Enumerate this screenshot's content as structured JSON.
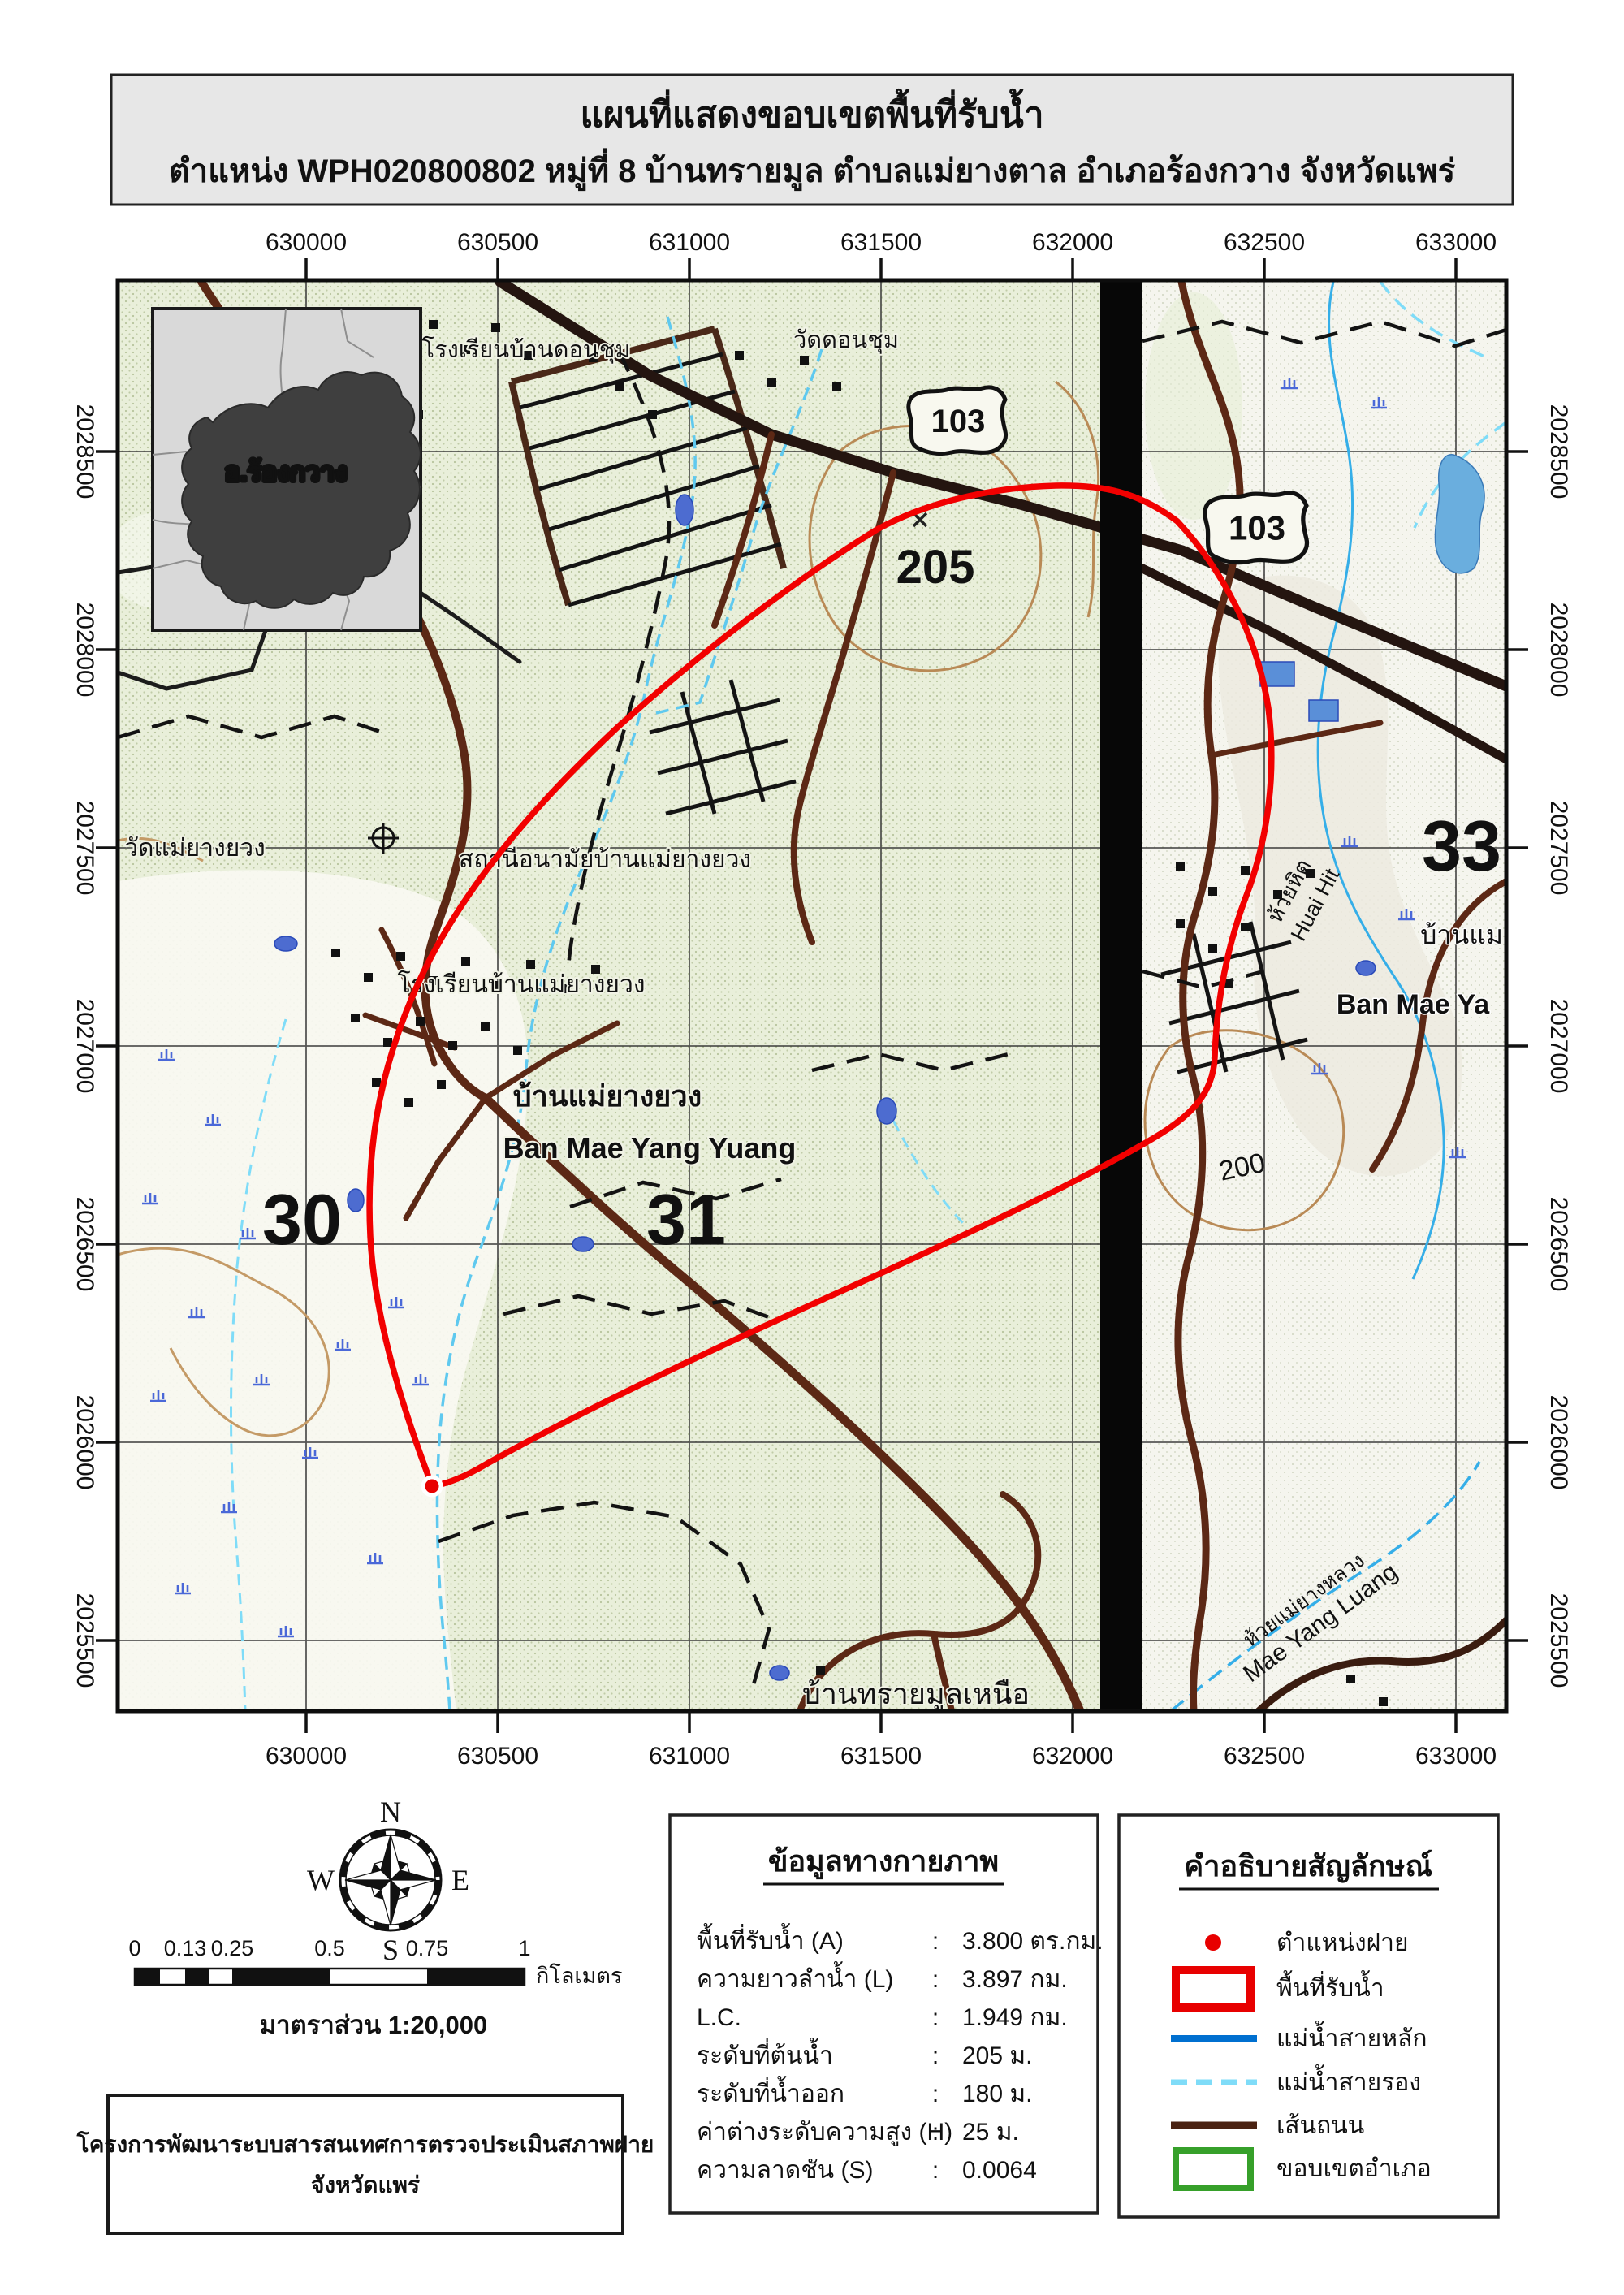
{
  "title": {
    "line1": "แผนที่แสดงขอบเขตพื้นที่รับน้ำ",
    "line2": "ตำแหน่ง WPH020800802 หมู่ที่ 8 บ้านทรายมูล ตำบลแม่ยางตาล อำเภอร้องกวาง จังหวัดแพร่"
  },
  "map": {
    "inset_label": "อ.ร้องกวาง",
    "route_number": "103",
    "axis": {
      "easting": [
        "630000",
        "630500",
        "631000",
        "631500",
        "632000",
        "632500",
        "633000"
      ],
      "northing": [
        "2028500",
        "2028000",
        "2027500",
        "2027000",
        "2026500",
        "2026000",
        "2025500"
      ]
    },
    "labels": {
      "school_don_chum": "โรงเรียนบ้านดอนชุม",
      "wat_don_chum": "วัดดอนชุม",
      "spot_height": "205",
      "contour_200": "200",
      "grid_30": "30",
      "grid_31": "31",
      "grid_33": "33",
      "wat_mae_yang_yuang": "วัดแม่ยางยวง",
      "health_station": "สถานีอนามัยบ้านแม่ยางยวง",
      "school_mae_yang_yuang": "โรงเรียนบ้านแม่ยางยวง",
      "village_thai": "บ้านแม่ยางยวง",
      "village_eng": "Ban Mae Yang Yuang",
      "ban_mae_thai_partial": "บ้านแม",
      "ban_mae_eng_partial": "Ban Mae Ya",
      "huai_hit_thai": "ห้วยหิต",
      "huai_hit_eng": "Huai Hit",
      "mae_yang_luang_thai": "ห้วยแม่ยางหลวง",
      "mae_yang_luang_eng": "Mae Yang Luang",
      "ban_sai_mun_nuea": "บ้านทรายมูลเหนือ"
    }
  },
  "compass": {
    "n": "N",
    "e": "E",
    "s": "S",
    "w": "W"
  },
  "scalebar": {
    "ticks": [
      "0",
      "0.13",
      "0.25",
      "0.5",
      "0.75",
      "1"
    ],
    "unit": "กิโลเมตร",
    "scale_text": "มาตราส่วน  1:20,000"
  },
  "physical": {
    "title": "ข้อมูลทางกายภาพ",
    "separator": ":",
    "rows": [
      {
        "label": "พื้นที่รับน้ำ (A)",
        "value": "3.800 ตร.กม."
      },
      {
        "label": "ความยาวลำน้ำ (L)",
        "value": "3.897 กม."
      },
      {
        "label": "L.C.",
        "value": "1.949 กม."
      },
      {
        "label": "ระดับที่ต้นน้ำ",
        "value": "205 ม."
      },
      {
        "label": "ระดับที่น้ำออก",
        "value": "180 ม."
      },
      {
        "label": "ค่าต่างระดับความสูง (H)",
        "value": "25 ม."
      },
      {
        "label": "ความลาดชัน (S)",
        "value": "0.0064"
      }
    ]
  },
  "legend": {
    "title": "คำอธิบายสัญลักษณ์",
    "items": [
      {
        "label": "ตำแหน่งฝาย"
      },
      {
        "label": "พื้นที่รับน้ำ"
      },
      {
        "label": "แม่น้ำสายหลัก"
      },
      {
        "label": "แม่น้ำสายรอง"
      },
      {
        "label": "เส้นถนน"
      },
      {
        "label": "ขอบเขตอำเภอ"
      }
    ]
  },
  "project": {
    "line1": "โครงการพัฒนาระบบสารสนเทศการตรวจประเมินสภาพฝาย",
    "line2": "จังหวัดแพร่"
  },
  "colors": {
    "watershed_boundary": "#f20000",
    "weir_point": "#e80000",
    "main_river": "#0070d0",
    "minor_river": "#7fdcf8",
    "road": "#5c2815",
    "district_boundary": "#36a02a"
  }
}
